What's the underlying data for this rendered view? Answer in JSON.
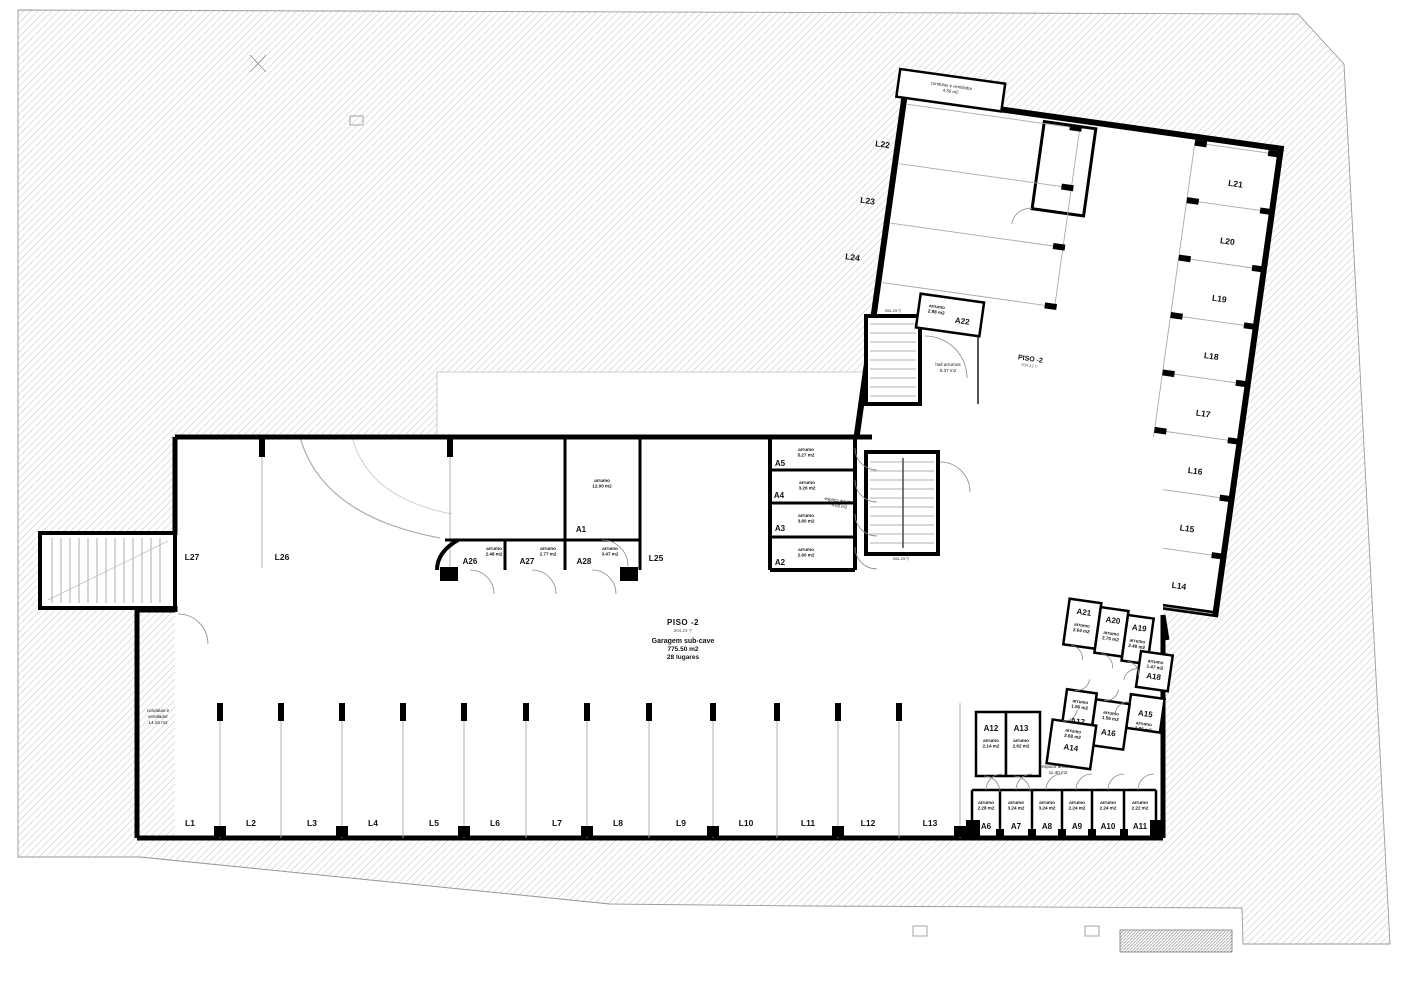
{
  "floor": {
    "main_label": "PISO -2",
    "main_elevation": "204.23",
    "garage_name": "Garagem sub-cave",
    "garage_area": "775.50 m2",
    "garage_capacity": "28 lugares",
    "wing_label": "PISO -2",
    "wing_elevation": "204.23"
  },
  "annotations": {
    "ducts_left": [
      "condutas e",
      "ventilador",
      "14.15 m2"
    ],
    "ducts_top": [
      "condutas e ventilador",
      "4.50 m2"
    ],
    "hall": [
      "hall arrumos",
      "5.37 m2"
    ],
    "storage_space_large": [
      "espaco arrumos",
      "11.40 m2"
    ],
    "storage_space_small": [
      "espaco arrumos",
      "4.50 m2"
    ]
  },
  "parking": {
    "bottom_row": [
      "L1",
      "L2",
      "L3",
      "L4",
      "L5",
      "L6",
      "L7",
      "L8",
      "L9",
      "L10",
      "L11",
      "L12",
      "L13"
    ],
    "middle_row": [
      "L27",
      "L26",
      "L25"
    ],
    "wing_right": [
      "L21",
      "L20",
      "L19",
      "L18",
      "L17",
      "L16",
      "L15",
      "L14"
    ],
    "wing_top": [
      "L22",
      "L23",
      "L24"
    ]
  },
  "storage": {
    "label_word": "arrumo",
    "rooms": [
      {
        "id": "A1",
        "area": "12.00 m2"
      },
      {
        "id": "A2",
        "area": "2.60 m2"
      },
      {
        "id": "A3",
        "area": "3.60 m2"
      },
      {
        "id": "A4",
        "area": "3.26 m2"
      },
      {
        "id": "A5",
        "area": "5.27 m2"
      },
      {
        "id": "A6",
        "area": "2.28 m2"
      },
      {
        "id": "A7",
        "area": "3.24 m2"
      },
      {
        "id": "A8",
        "area": "3.24 m2"
      },
      {
        "id": "A9",
        "area": "2.24 m2"
      },
      {
        "id": "A10",
        "area": "2.24 m2"
      },
      {
        "id": "A11",
        "area": "2.22 m2"
      },
      {
        "id": "A12",
        "area": "2.14 m2"
      },
      {
        "id": "A13",
        "area": "2.62 m2"
      },
      {
        "id": "A14",
        "area": "2.68 m2"
      },
      {
        "id": "A15",
        "area": "2.96 m2"
      },
      {
        "id": "A16",
        "area": "1.56 m2"
      },
      {
        "id": "A17",
        "area": "1.56 m2"
      },
      {
        "id": "A18",
        "area": "1.47 m2"
      },
      {
        "id": "A19",
        "area": "2.49 m2"
      },
      {
        "id": "A20",
        "area": "2.70 m2"
      },
      {
        "id": "A21",
        "area": "2.64 m2"
      },
      {
        "id": "A22",
        "area": "2.98 m2"
      },
      {
        "id": "A26",
        "area": "2.48 m2"
      },
      {
        "id": "A27",
        "area": "2.77 m2"
      },
      {
        "id": "A28",
        "area": "3.47 m2"
      }
    ]
  }
}
